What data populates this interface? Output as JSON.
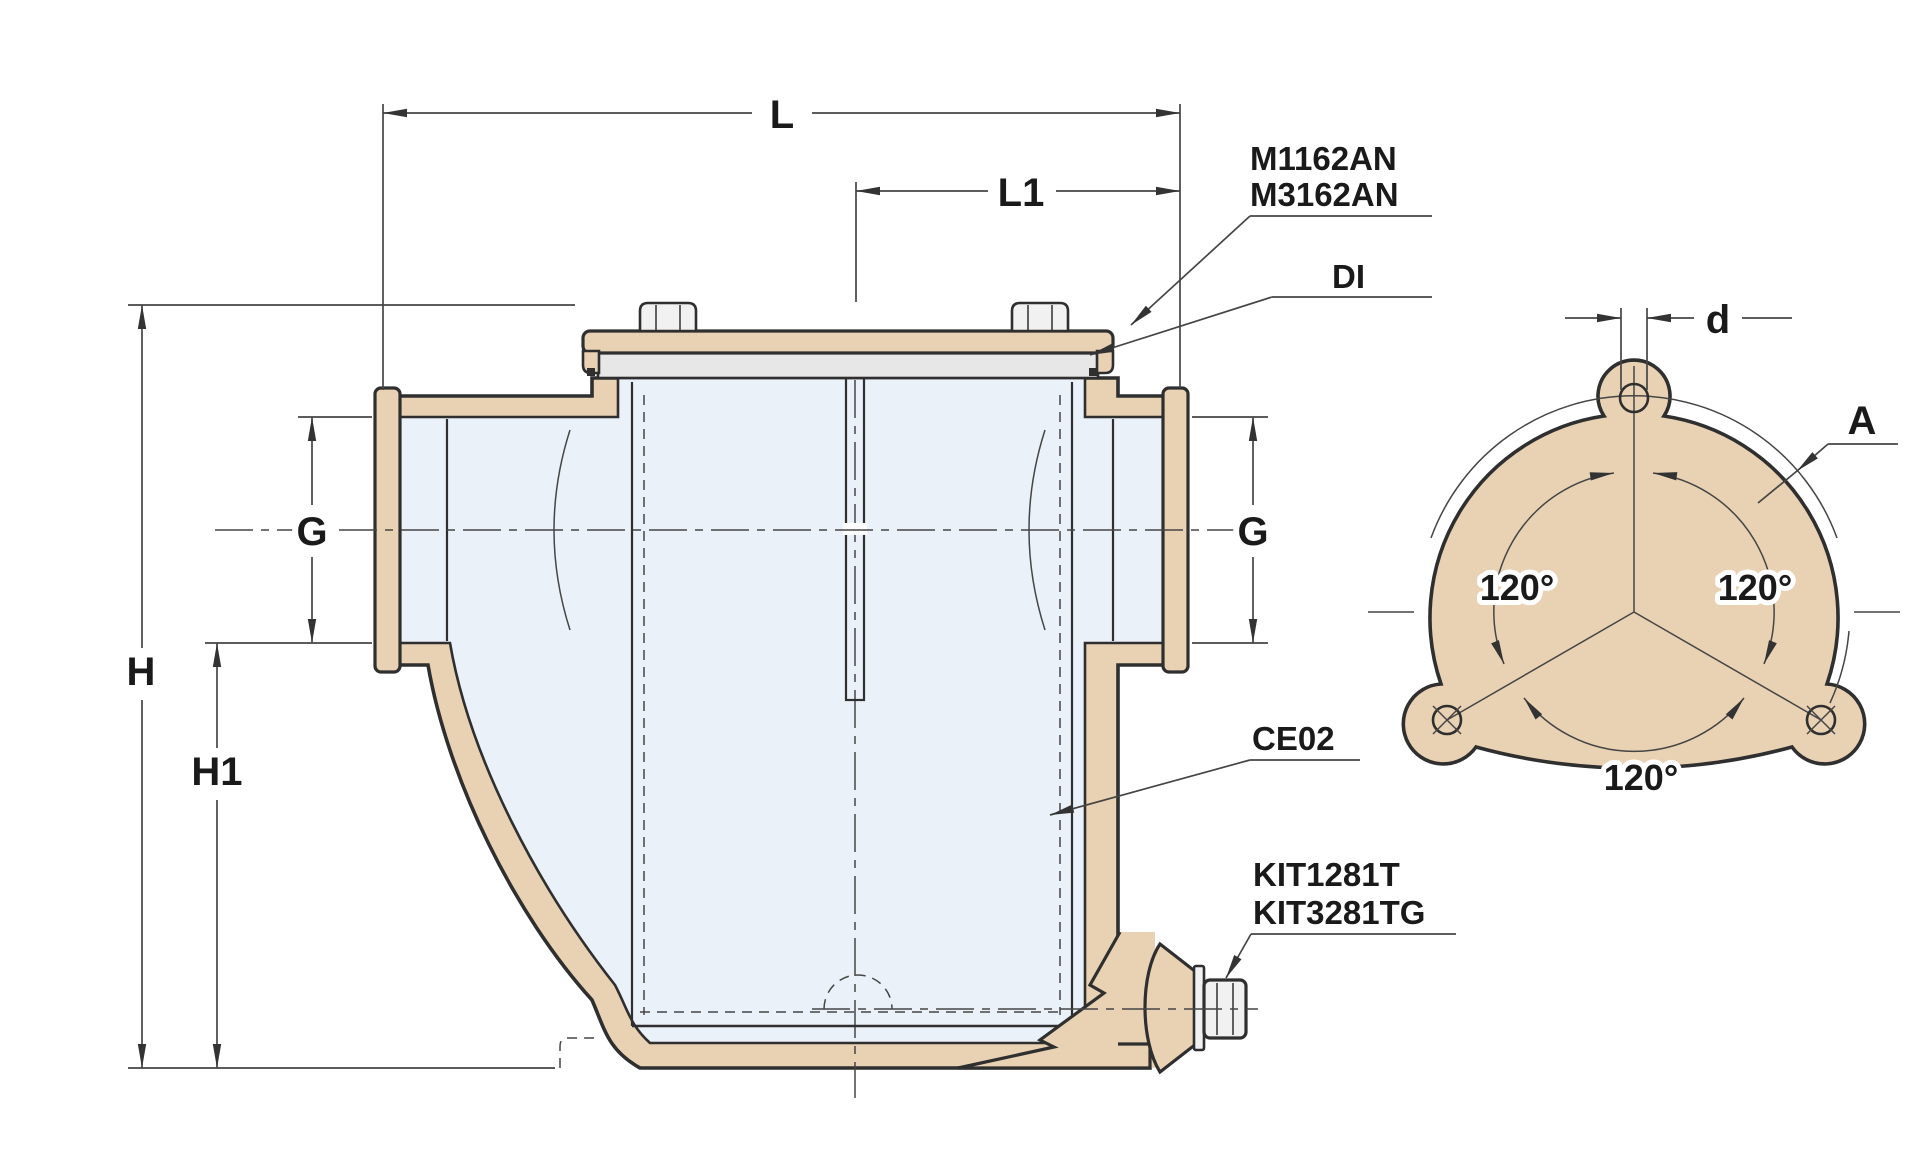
{
  "drawing_title": "Water strainer cross-section and mounting flange technical drawing",
  "colors": {
    "tan": "#e9d2b3",
    "interior": "#ebf1f8",
    "lid_gray": "#e7e7e7",
    "metal_light": "#f1f1f1",
    "line": "#2f2f2f",
    "thin_line": "#454545",
    "text": "#1a1a1a"
  },
  "section": {
    "dims": {
      "L": "L",
      "L1": "L1",
      "H": "H",
      "H1": "H1",
      "G_left": "G",
      "G_right": "G"
    },
    "callouts": {
      "model_line1": "M1162AN",
      "model_line2": "M3162AN",
      "lid": "DI",
      "basket": "CE02",
      "drain_kit_line1": "KIT1281T",
      "drain_kit_line2": "KIT3281TG"
    }
  },
  "flange": {
    "dims": {
      "hole_diameter": "d",
      "bolt_circle": "A"
    },
    "angles": [
      "120°",
      "120°",
      "120°"
    ]
  }
}
